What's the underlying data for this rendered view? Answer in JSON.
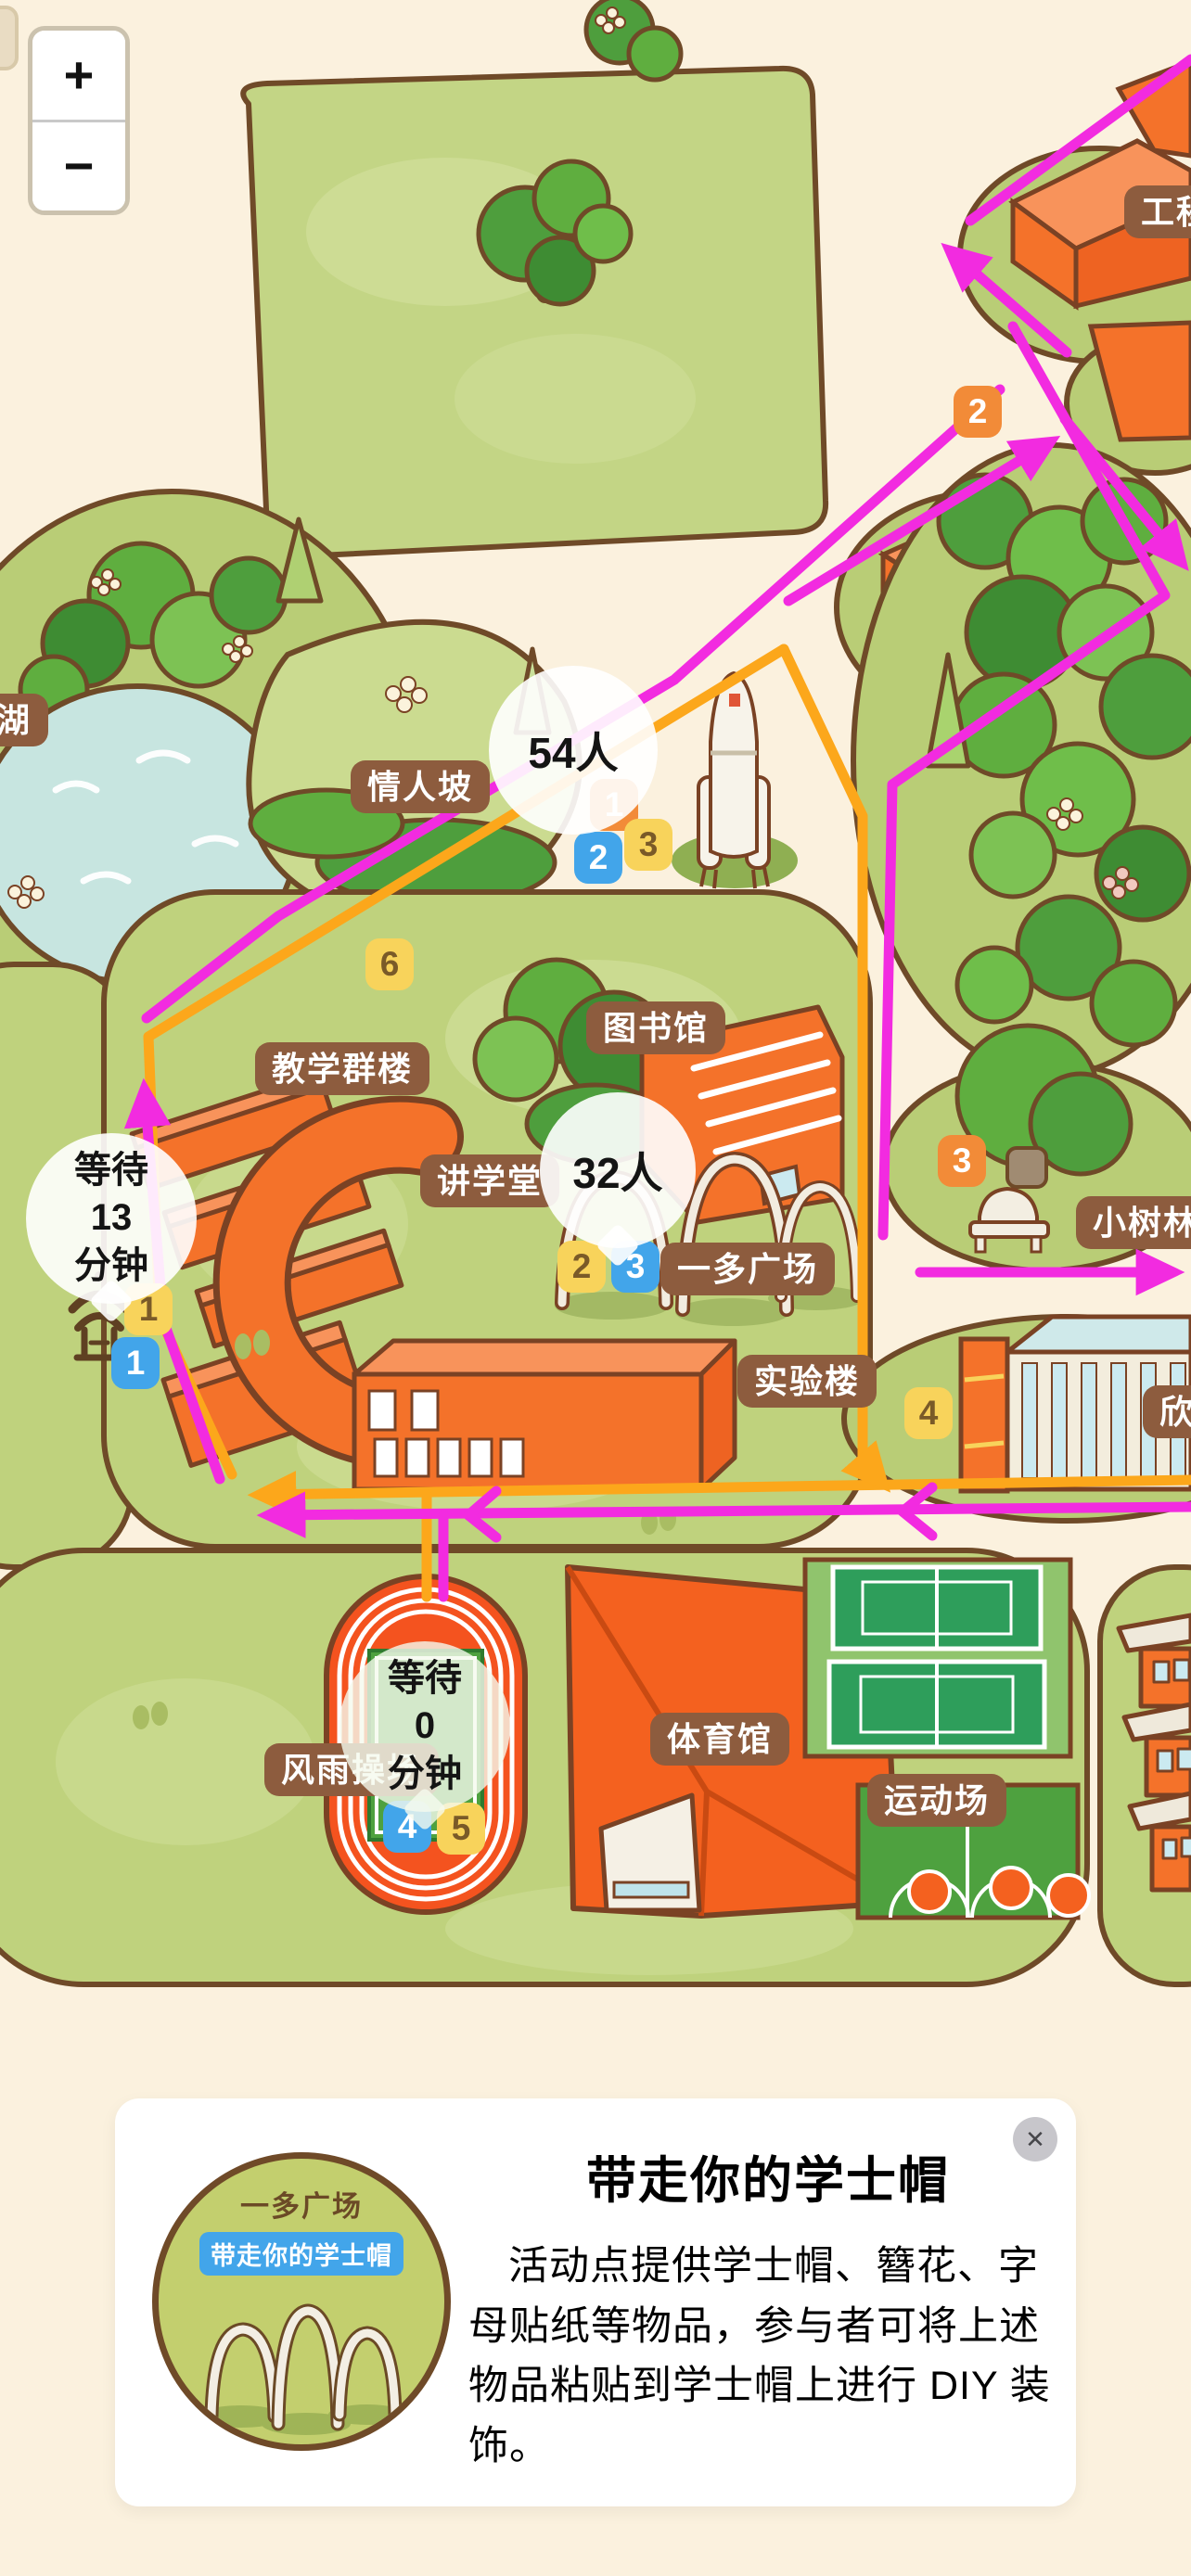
{
  "zoom_controls": {
    "zoom_in": "+",
    "zoom_out": "−"
  },
  "map": {
    "place_labels": [
      {
        "id": "engineering",
        "text": "工程"
      },
      {
        "id": "lovers-slope",
        "text": "情人坡"
      },
      {
        "id": "lake",
        "text": "工湖"
      },
      {
        "id": "teaching-complex",
        "text": "教学群楼"
      },
      {
        "id": "library",
        "text": "图书馆"
      },
      {
        "id": "lecture-hall",
        "text": "讲学堂"
      },
      {
        "id": "yiduo-plaza",
        "text": "一多广场"
      },
      {
        "id": "laboratory-building",
        "text": "实验楼"
      },
      {
        "id": "xin-building",
        "text": "欣"
      },
      {
        "id": "grove",
        "text": "小树林"
      },
      {
        "id": "gymnasium",
        "text": "体育馆"
      },
      {
        "id": "sports-field",
        "text": "运动场"
      },
      {
        "id": "track-field",
        "text": "风雨操场"
      }
    ],
    "markers": [
      {
        "label": "2",
        "color": "orange"
      },
      {
        "label": "1",
        "color": "orange"
      },
      {
        "label": "2",
        "color": "blue"
      },
      {
        "label": "3",
        "color": "yellow"
      },
      {
        "label": "6",
        "color": "yellow"
      },
      {
        "label": "1",
        "color": "yellow"
      },
      {
        "label": "1",
        "color": "blue"
      },
      {
        "label": "2",
        "color": "yellow"
      },
      {
        "label": "3",
        "color": "blue"
      },
      {
        "label": "3",
        "color": "orange"
      },
      {
        "label": "4",
        "color": "yellow"
      },
      {
        "label": "4",
        "color": "blue"
      },
      {
        "label": "5",
        "color": "yellow"
      }
    ],
    "bubbles": {
      "count_a": "54人",
      "count_b": "32人",
      "wait_a": {
        "line1": "等待",
        "line2": "13",
        "line3": "分钟"
      },
      "wait_b": {
        "line1": "等待",
        "line2": "0",
        "line3": "分钟"
      }
    },
    "colors": {
      "background": "#FBF1DE",
      "grass": "#BFD27D",
      "building_orange": "#F4722A",
      "route_magenta": "#F22BE0",
      "route_orange": "#FCA71B",
      "marker_orange": "#F28B38",
      "marker_blue": "#42A5EA",
      "marker_yellow": "#F8D35B",
      "label_brown": "#8D5C3E",
      "lake_blue": "#C7E5E0"
    }
  },
  "card": {
    "title": "带走你的学士帽",
    "description": "活动点提供学士帽、簪花、字母贴纸等物品，参与者可将上述物品粘贴到学士帽上进行 DIY 装饰。",
    "close_label": "✕",
    "image": {
      "place": "一多广场",
      "badge": "带走你的学士帽"
    }
  }
}
